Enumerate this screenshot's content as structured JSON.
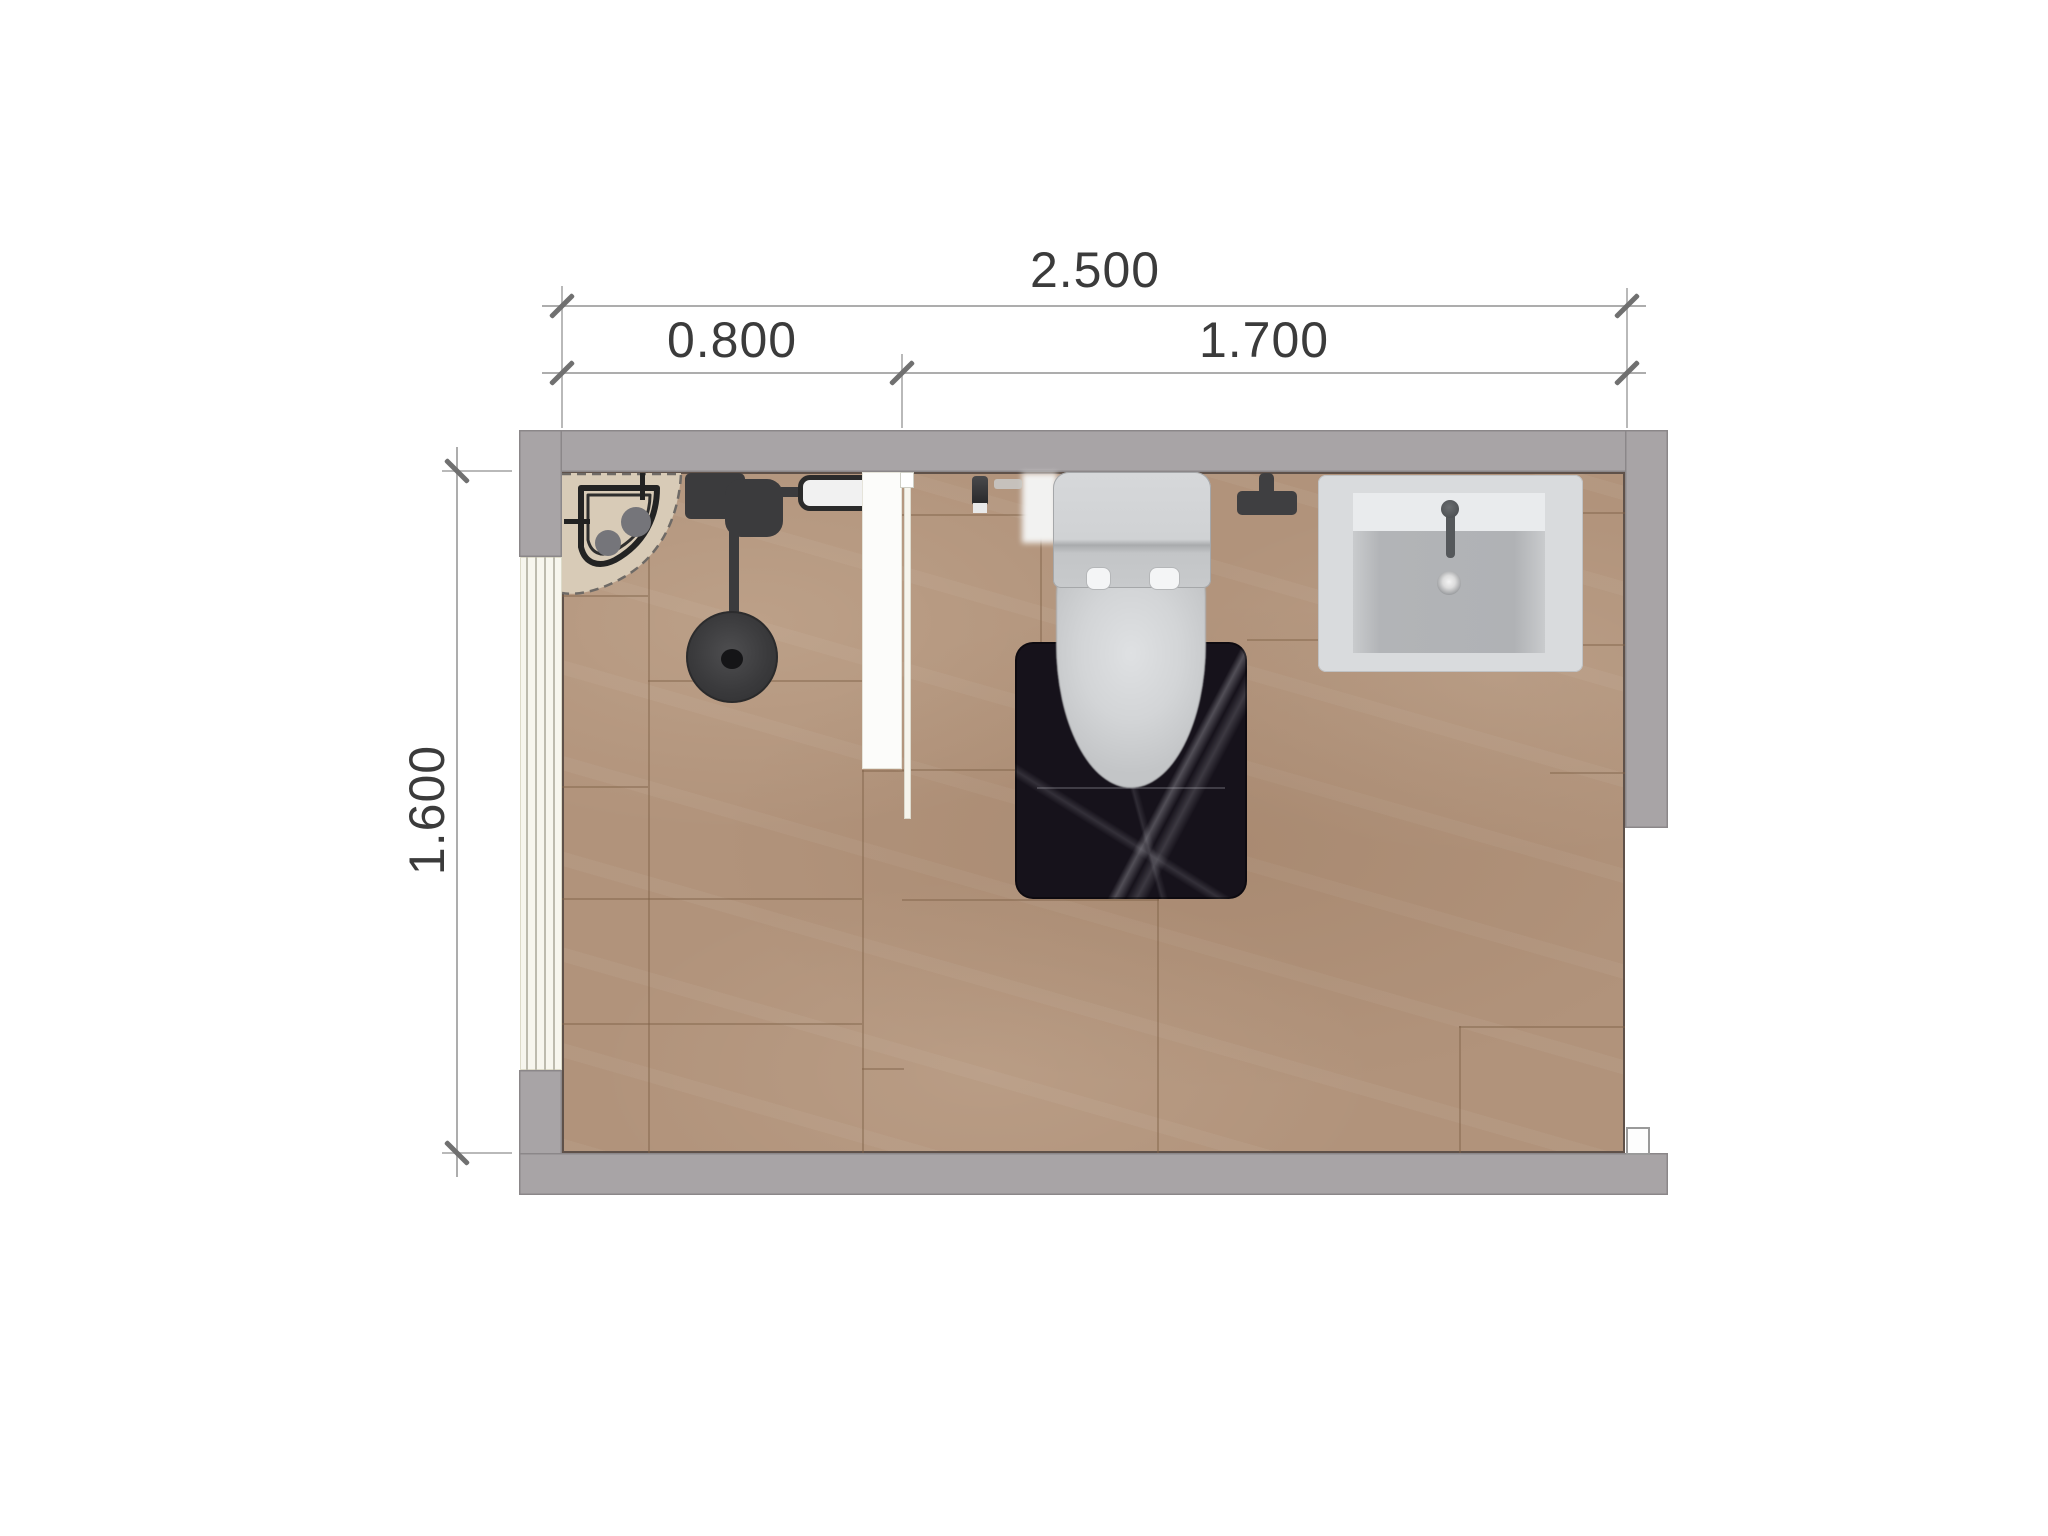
{
  "document": {
    "type": "bathroom-floor-plan",
    "view": "top-down"
  },
  "dimensions": {
    "total_width": "2.500",
    "left_segment": "0.800",
    "right_segment": "1.700",
    "room_depth": "1.600"
  },
  "fixtures": [
    {
      "name": "corner-shower-tray"
    },
    {
      "name": "shower-mixer"
    },
    {
      "name": "shower-drain"
    },
    {
      "name": "shower-shelf"
    },
    {
      "name": "partition-wall"
    },
    {
      "name": "glass-panel"
    },
    {
      "name": "door-opening"
    },
    {
      "name": "toiletries"
    },
    {
      "name": "toilet"
    },
    {
      "name": "bath-mat"
    },
    {
      "name": "paper-stand"
    },
    {
      "name": "washbasin"
    }
  ],
  "theme": {
    "wall": "#a8a4a6",
    "wall_outline": "#8b8789",
    "floor": "#b1937b",
    "grout": "#7e6248",
    "tray": "#d8cbb7",
    "dark": "#3b3b3d",
    "white_fix": "#f1f1f1",
    "ceramic": "#ced0d2",
    "basin": "#d9dbdd",
    "mat": "#16121b",
    "dim_line": "#adadad",
    "tick": "#707070",
    "text": "#3b3b3b",
    "door": "#f7f6ee",
    "glass": "#f6f4ec"
  }
}
